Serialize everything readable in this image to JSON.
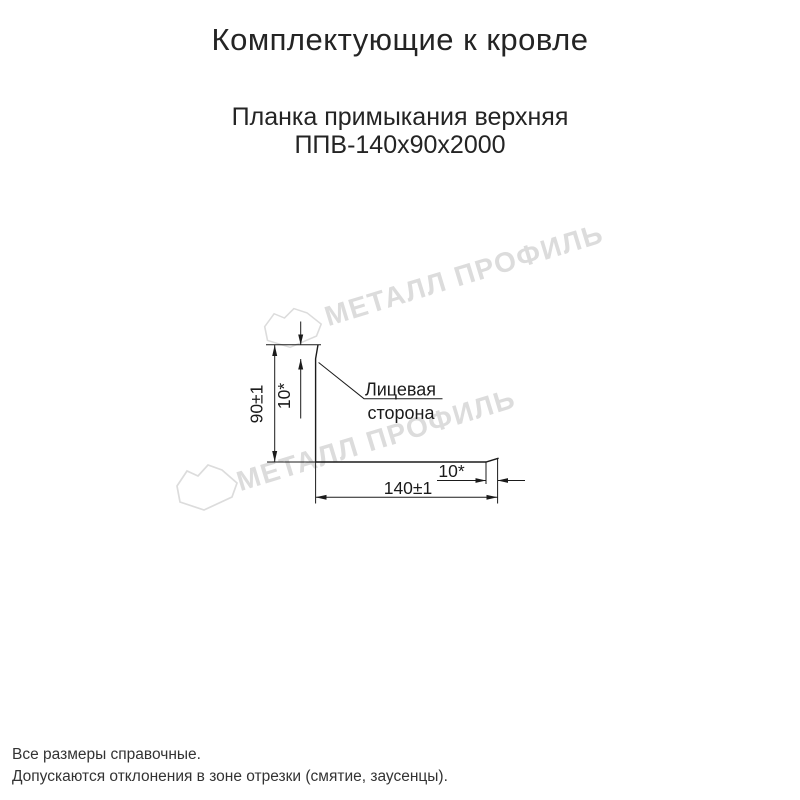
{
  "page": {
    "title": "Комплектующие к кровле",
    "product": {
      "name": "Планка примыкания верхняя",
      "code": "ППВ-140х90х2000"
    }
  },
  "drawing": {
    "dim_height": "90±1",
    "dim_top_lip": "10*",
    "dim_width": "140±1",
    "dim_end_lip": "10*",
    "face_side_line1": "Лицевая",
    "face_side_line2": "сторона"
  },
  "watermark": {
    "text": "МЕТАЛЛ ПРОФИЛЬ",
    "color": "#dcdcdc"
  },
  "footer": {
    "line1": "Все размеры справочные.",
    "line2": "Допускаются отклонения в зоне отрезки (смятие, заусенцы)."
  },
  "colors": {
    "ink": "#1b1b1b",
    "watermark": "#dcdcdc",
    "background": "#ffffff"
  }
}
